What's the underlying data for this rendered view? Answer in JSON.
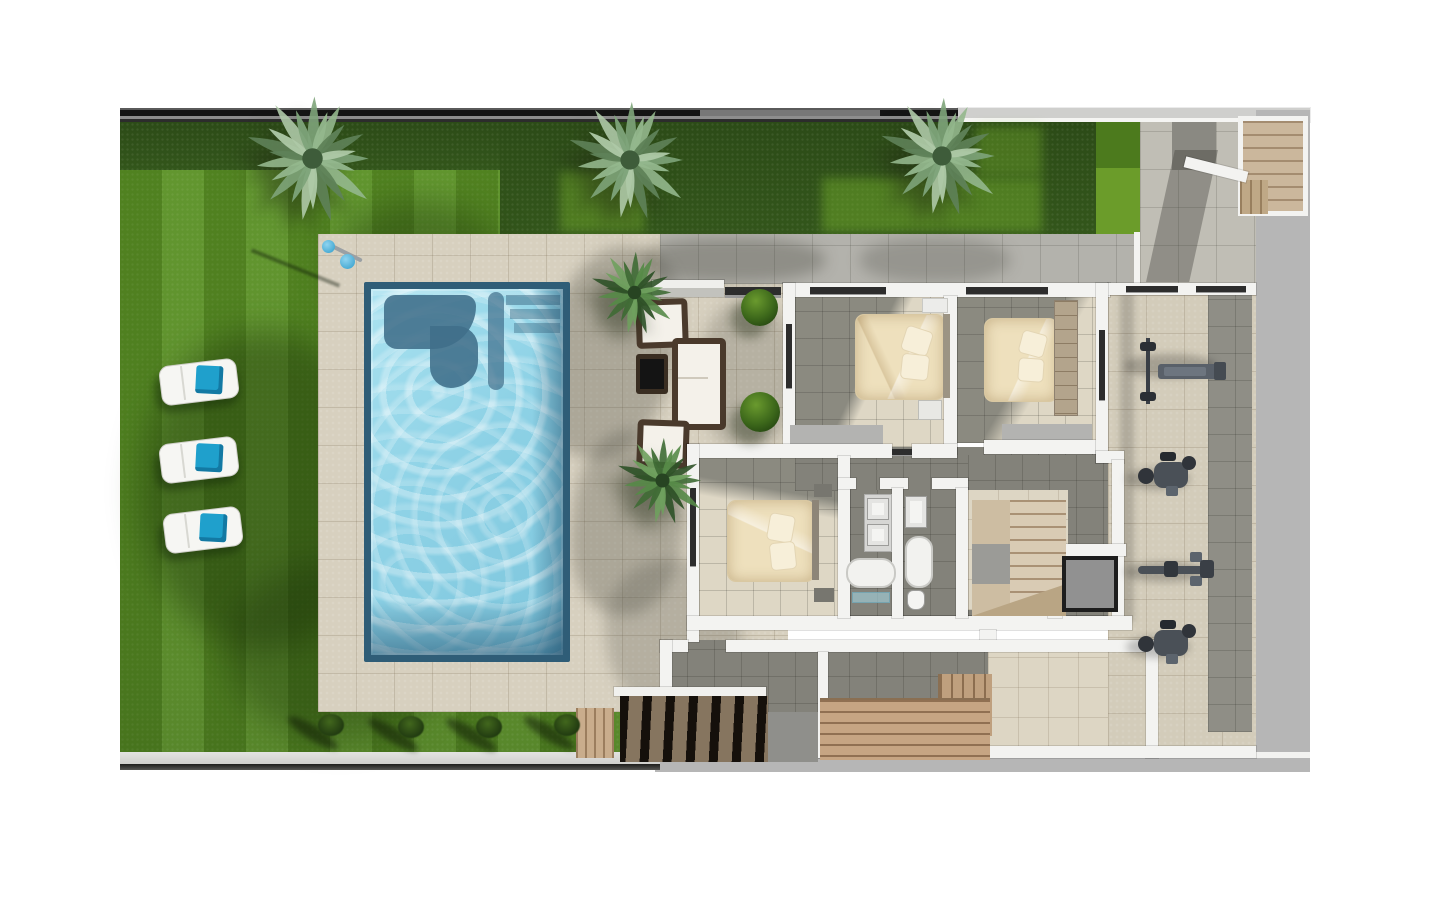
{
  "scene": {
    "type": "architectural-floor-plan-render",
    "view": "top-down",
    "setting": "villa first floor with garden, swimming pool, three bedrooms, two bathrooms, stairs, elevator and gym terrace",
    "visible_text": "none"
  },
  "palette": {
    "background": "#ffffff",
    "grass": "#578c23",
    "hedge": "#2f5018",
    "deck_tile": "#d7d0bf",
    "walkway_tile": "#b3b2ac",
    "interior_dark_tile": "#83827a",
    "interior_light_tile": "#ddd6c4",
    "pool_water": "#8ed2e6",
    "pool_feature": "#406e8a",
    "wall_white": "#f3f3f1",
    "wall_core_gray": "#b3b3b1",
    "concrete_band": "#b6b6b6",
    "fence_dark": "#161616",
    "wood_bench": "#c6a583",
    "wood_stair": "#d9cbb4",
    "dark_stair_treads": "#2a221a",
    "bed_linen": "#eee0bd",
    "towel_blue": "#1fa0cc",
    "lounger_white": "#f6f6f3",
    "equipment_gray": "#4a5057",
    "elevator_frame": "#1d1d1d",
    "elevator_fill": "#919191"
  },
  "garden": {
    "palm_trees": [
      {
        "name": "palm-tree-top-left",
        "x": 312,
        "y": 158,
        "r": 64,
        "tone": "light"
      },
      {
        "name": "palm-tree-top-center",
        "x": 630,
        "y": 160,
        "r": 60,
        "tone": "light"
      },
      {
        "name": "palm-tree-top-right",
        "x": 942,
        "y": 156,
        "r": 60,
        "tone": "light"
      },
      {
        "name": "palm-deck-upper",
        "x": 634,
        "y": 292,
        "r": 42,
        "tone": "dark"
      },
      {
        "name": "palm-deck-lower",
        "x": 662,
        "y": 480,
        "r": 44,
        "tone": "dark"
      }
    ],
    "sun_loungers": [
      {
        "x": 160,
        "y": 362
      },
      {
        "x": 160,
        "y": 440
      },
      {
        "x": 164,
        "y": 510
      }
    ],
    "shrubs_bottom": [
      {
        "x": 318,
        "y": 714
      },
      {
        "x": 398,
        "y": 716
      },
      {
        "x": 476,
        "y": 716
      },
      {
        "x": 554,
        "y": 714
      }
    ],
    "round_bushes": [
      {
        "x": 741,
        "y": 289,
        "d": 37
      },
      {
        "x": 740,
        "y": 392,
        "d": 40
      }
    ],
    "outdoor_shower": {
      "x": 318,
      "y": 238
    }
  },
  "pool": {
    "x": 364,
    "y": 282,
    "width": 206,
    "height": 380,
    "features": [
      "corner steps",
      "curved in-pool bench",
      "shaded right edge"
    ]
  },
  "lounge_set": {
    "items": [
      "wicker armchair",
      "wicker armchair",
      "wicker sofa",
      "dark coffee table",
      "garden bench wall"
    ]
  },
  "house": {
    "bedrooms": 3,
    "bathrooms": 2,
    "features": [
      "double beds",
      "wardrobes",
      "twin-sink vanity",
      "bathtubs",
      "U-shaped wooden staircase",
      "elevator",
      "sauna bench deck",
      "basement stair",
      "entry stair top-right"
    ]
  },
  "gym": {
    "machines": [
      {
        "type": "bench-press",
        "x": 1138,
        "y": 338
      },
      {
        "type": "exercise-bike",
        "x": 1138,
        "y": 452
      },
      {
        "type": "rowing-machine",
        "x": 1138,
        "y": 548
      },
      {
        "type": "exercise-bike",
        "x": 1138,
        "y": 620
      }
    ]
  }
}
